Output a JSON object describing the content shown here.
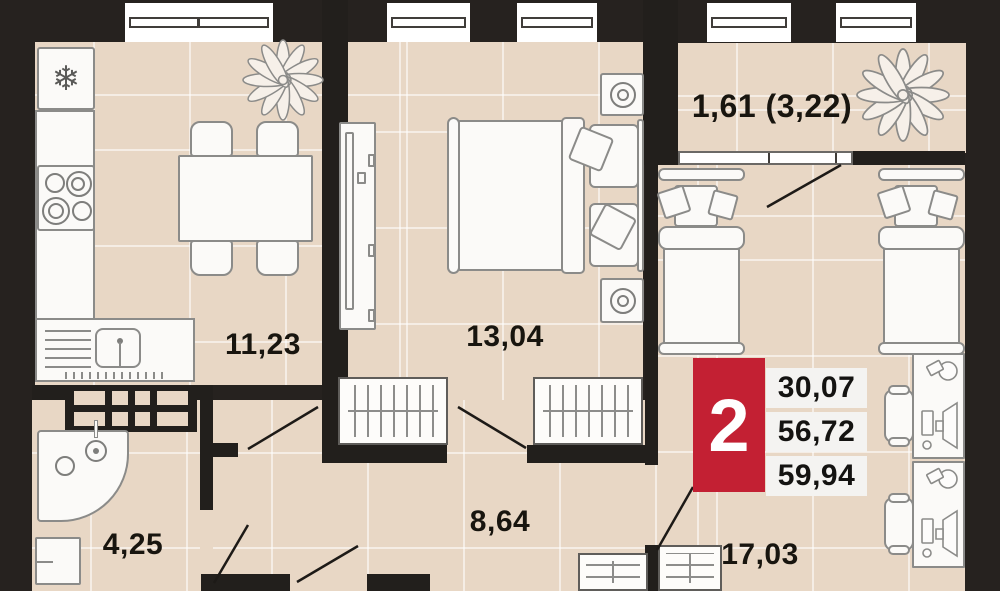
{
  "badge": {
    "room_count": "2",
    "values": [
      "30,07",
      "56,72",
      "59,94"
    ],
    "accent_color": "#c32033"
  },
  "rooms": {
    "kitchen": {
      "area_label": "11,23"
    },
    "bedroom": {
      "area_label": "13,04"
    },
    "hallway": {
      "area_label": "8,64"
    },
    "bathroom": {
      "area_label": "4,25"
    },
    "bedroom2": {
      "area_label": "17,03"
    },
    "balcony": {
      "area_label": "1,61 (3,22)"
    }
  },
  "icons": {
    "snowflake": "❄"
  },
  "colors": {
    "floor": "#e8d7c5",
    "wall": "#26221f",
    "accent_red": "#c32033",
    "grout": "#ffffff"
  }
}
